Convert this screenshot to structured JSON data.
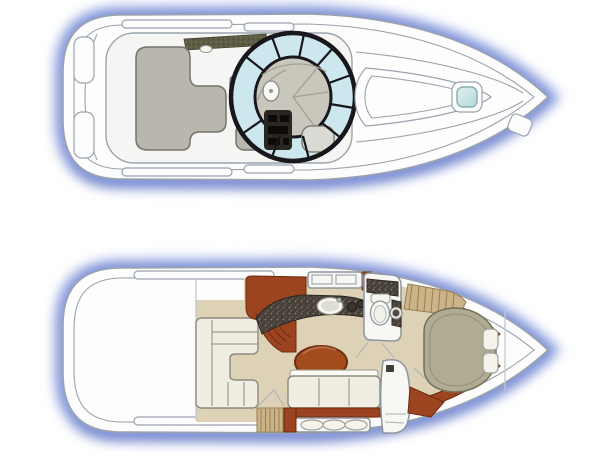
{
  "figure": {
    "title": "Boat floor plan — deck view (top) and cabin view (bottom)",
    "views": [
      {
        "name": "deck-plan",
        "position": "top",
        "parts": [
          "hull",
          "transom-lockers",
          "cockpit-lounge-seating",
          "wet-bar-bench",
          "engine-hatch-seat",
          "helm-console",
          "steering-wheel",
          "helm-seat",
          "wraparound-windshield",
          "windshield-walkthrough-pad",
          "foredeck-walkway",
          "bow-hatch",
          "anchor-locker-hatch"
        ]
      },
      {
        "name": "cabin-plan",
        "position": "bottom",
        "parts": [
          "hull",
          "salon-settee",
          "dinette-table",
          "companionway-steps",
          "companionway-ladder",
          "galley-cabinets",
          "galley-counter",
          "galley-sink",
          "head-compartment",
          "toilet",
          "head-sink",
          "hanging-locker",
          "v-berth",
          "berth-pillows",
          "mid-cabin-berth",
          "mid-cabin-cushions",
          "entertainment-cabinet",
          "wood-trim"
        ]
      }
    ]
  },
  "colors": {
    "hullFill": "#fdfdfd",
    "hullLine": "#9aa3ae",
    "deckPanel": "#f5f6f3",
    "glowLight": "#c7d2ef",
    "glowMid": "#7b8fd8",
    "glowDark": "#3f5ab2",
    "upholstery": "#b9b6ae",
    "upholsteryLight": "#dadad5",
    "upholsteryLine": "#75736b",
    "glass": "#cde7ee",
    "frame": "#17171c",
    "dashGray": "#c9c6bc",
    "dashLine": "#a3a096",
    "console": "#2a2722",
    "consoleBlack": "#0c0b09",
    "olive": "#5d5c45",
    "oliveDot": "#7d7c58",
    "carpet": "#ddd2b6",
    "settee": "#f0ede2",
    "setteeLine": "#8b8b80",
    "wood": "#9c4420",
    "woodDark": "#6e2c10",
    "table": "#a54c1e",
    "tableEdge": "#6f2d10",
    "tableHighlight": "#c28057",
    "granite": "#474038",
    "graniteEdge": "#2b2620",
    "graniteSpeckLight": "#8a8274",
    "graniteSpeckDark": "#5f5950",
    "graniteSpeckPale": "#9c9482",
    "cedar": "#cdb488",
    "cedarLine": "#937f55",
    "berth": "#b2ab93",
    "berthLine": "#73705c",
    "fixture": "#f7f7f4",
    "fixtureLine": "#8e959e",
    "hatchGlassA": "#e0f0ec",
    "hatchGlassB": "#b4d8da",
    "doorLine": "#aab0b8",
    "bulkhead": "#c3c8cf",
    "pillow": "#f5f3ec"
  }
}
